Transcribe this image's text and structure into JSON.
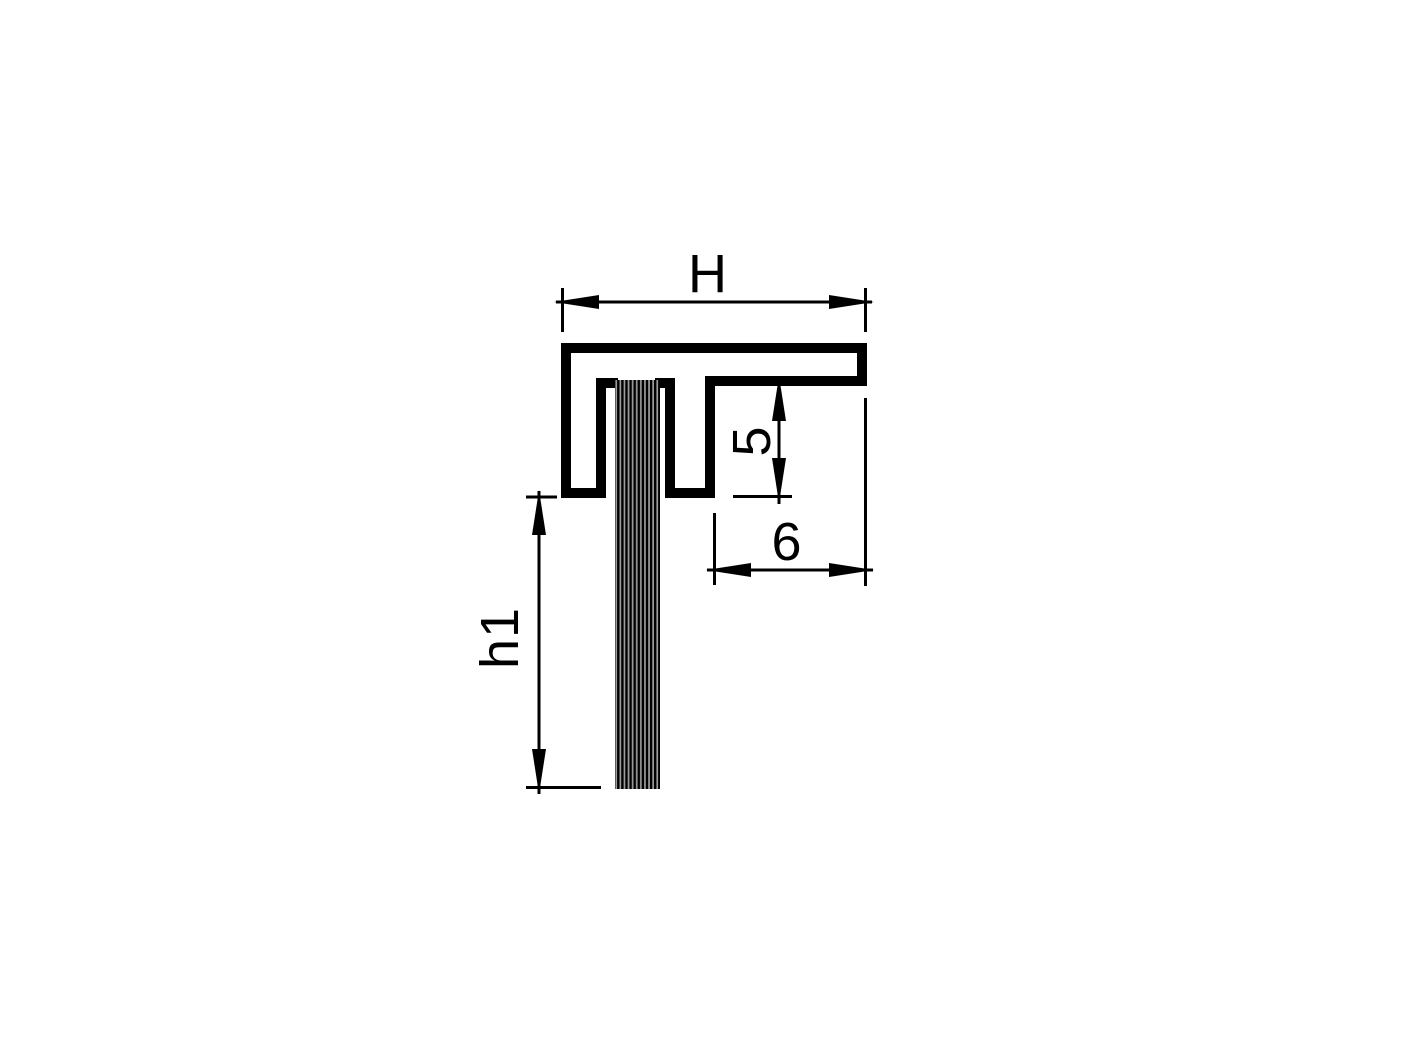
{
  "drawing": {
    "type": "profile-cross-section",
    "description_labels": {
      "overall_width_label": "H",
      "arm_depth_label": "5",
      "arm_overhang_label": "6",
      "brush_free_length_label": "h1"
    }
  },
  "dimensions": {
    "overall_width": {
      "label": "H"
    },
    "arm_depth": {
      "label": "5"
    },
    "arm_overhang": {
      "label": "6"
    },
    "brush_free_length": {
      "label": "h1"
    }
  },
  "colors": {
    "line_color": "#000000",
    "bristle_gray": "#9c9c9c",
    "background": "#ffffff"
  }
}
